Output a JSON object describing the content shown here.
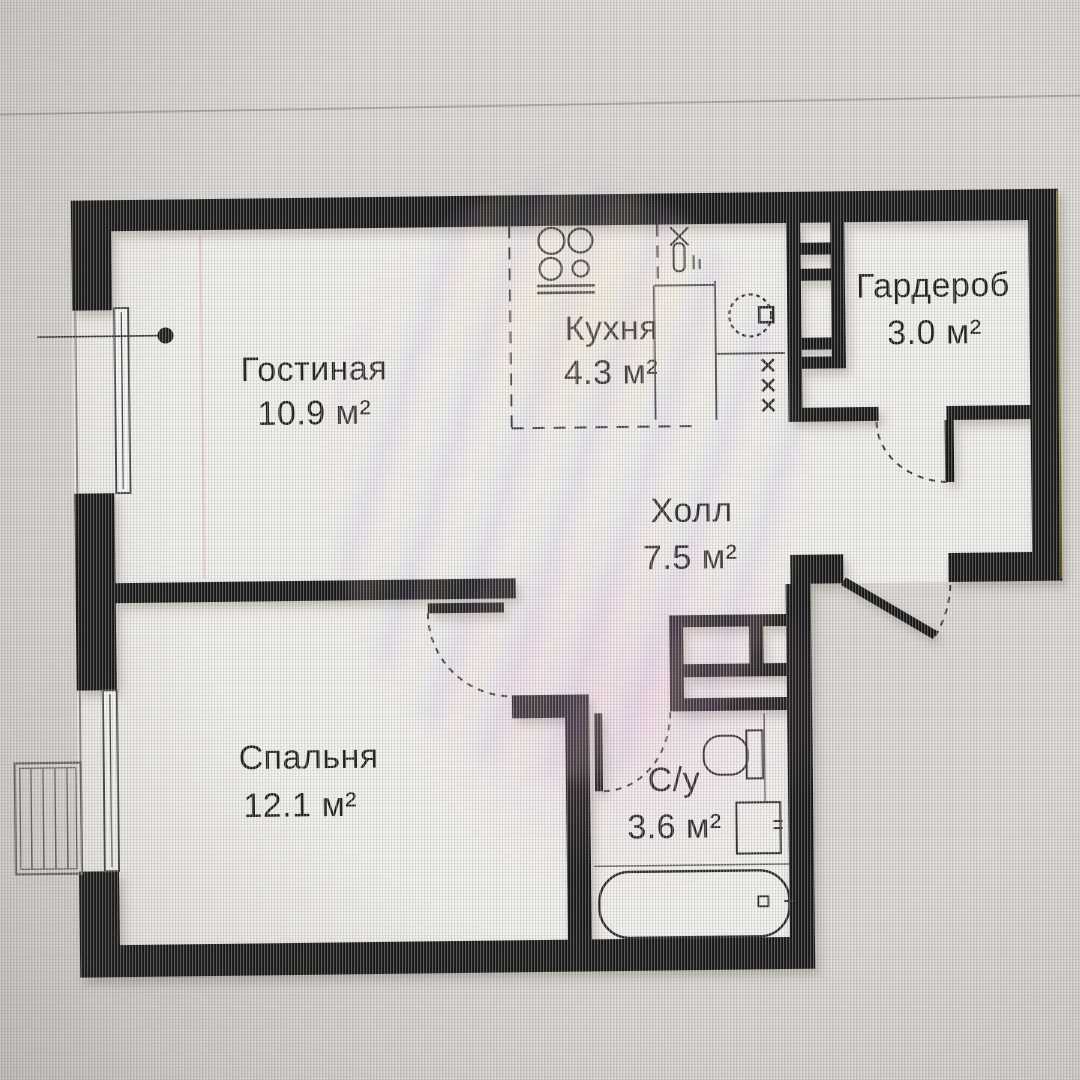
{
  "image": {
    "kind": "apartment floor plan (photo of a screen)",
    "language": "Russian",
    "area_unit": "м²"
  },
  "rooms": [
    {
      "key": "living",
      "name": "Гостиная",
      "area": "10.9 м²"
    },
    {
      "key": "kitchen",
      "name": "Кухня",
      "area": "4.3 м²"
    },
    {
      "key": "wardrobe",
      "name": "Гардероб",
      "area": "3.0 м²"
    },
    {
      "key": "hall",
      "name": "Холл",
      "area": "7.5 м²"
    },
    {
      "key": "bedroom",
      "name": "Спальня",
      "area": "12.1 м²"
    },
    {
      "key": "bathroom",
      "name": "С/у",
      "area": "3.6 м²"
    }
  ],
  "colors": {
    "wall": "#171717",
    "thin_line": "#4a4a4a",
    "floor": "#f1efec",
    "screen_background": "#d9d6d3",
    "label_text": "#222222"
  }
}
